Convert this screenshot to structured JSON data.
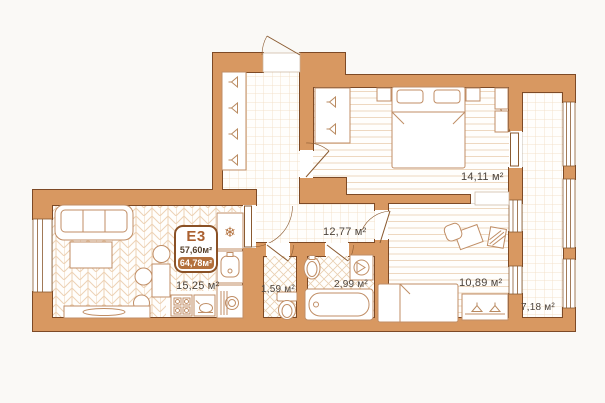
{
  "plan": {
    "badge": {
      "code": "E3",
      "area_living": "57,60м²",
      "area_total": "64,78м²"
    },
    "rooms": {
      "kitchen_living": {
        "label": "15,25 м²"
      },
      "hallway": {
        "label": "12,77 м²"
      },
      "wc": {
        "label": "1,59 м²"
      },
      "bathroom": {
        "label": "2,99 м²"
      },
      "bedroom": {
        "label": "14,11 м²"
      },
      "room": {
        "label": "10,89 м²"
      },
      "balcony": {
        "label": "7,18 м²"
      }
    },
    "icons": {
      "snowflake": "❄"
    },
    "colors": {
      "wall_fill": "#d89861",
      "wall_stroke": "#7d4a26",
      "accent": "#b3703c",
      "label_text": "#4c433b",
      "floor_line": "#ecd2b6"
    }
  }
}
